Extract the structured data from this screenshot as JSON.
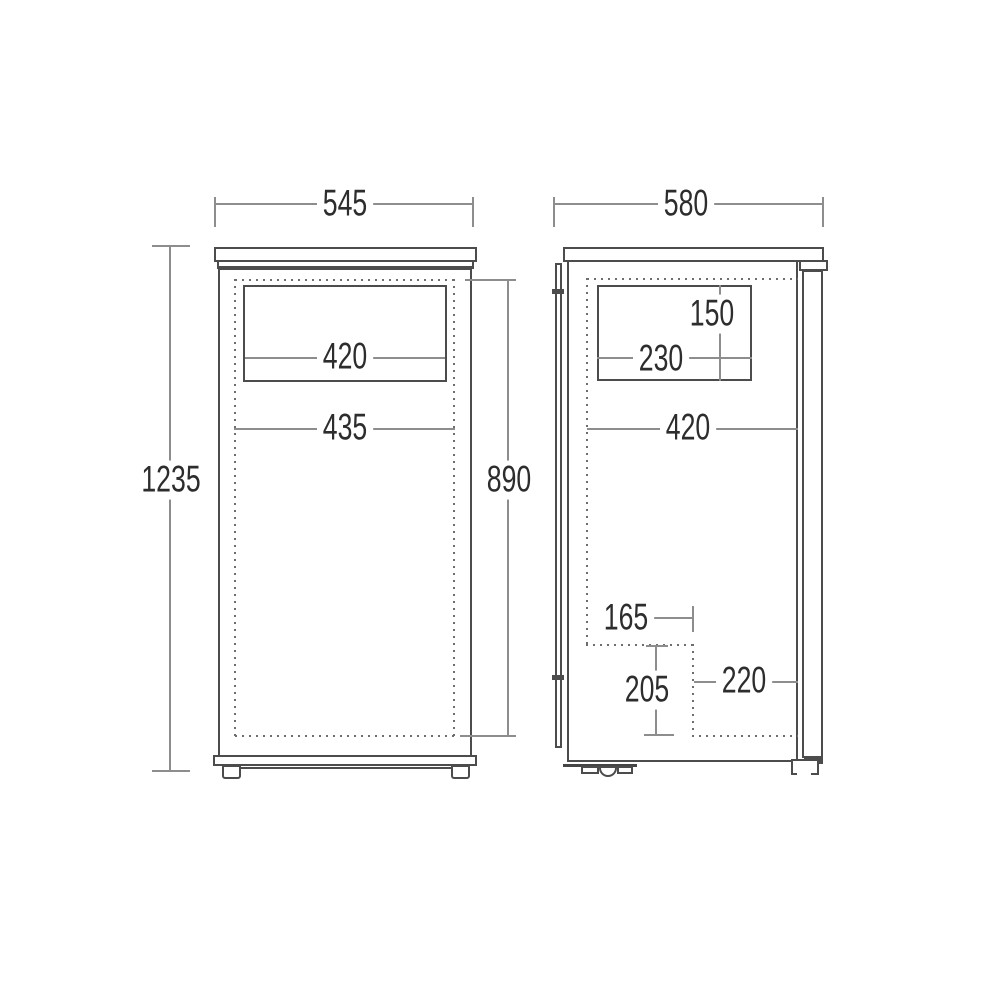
{
  "colors": {
    "outline": "#4c4c4c",
    "dimension_line": "#8d8d8d",
    "dotted_line": "#6e6e6e",
    "text": "#2d2d2d",
    "background": "#ffffff"
  },
  "views": {
    "front": {
      "dimensions": {
        "overall_width": "545",
        "overall_height": "1235",
        "interior_height": "890",
        "compartment_width": "420",
        "interior_width": "435"
      }
    },
    "side": {
      "dimensions": {
        "overall_depth": "580",
        "compartment_height": "150",
        "compartment_depth": "230",
        "interior_depth": "420",
        "recess_inset": "165",
        "recess_height": "205",
        "recess_depth": "220"
      }
    }
  }
}
